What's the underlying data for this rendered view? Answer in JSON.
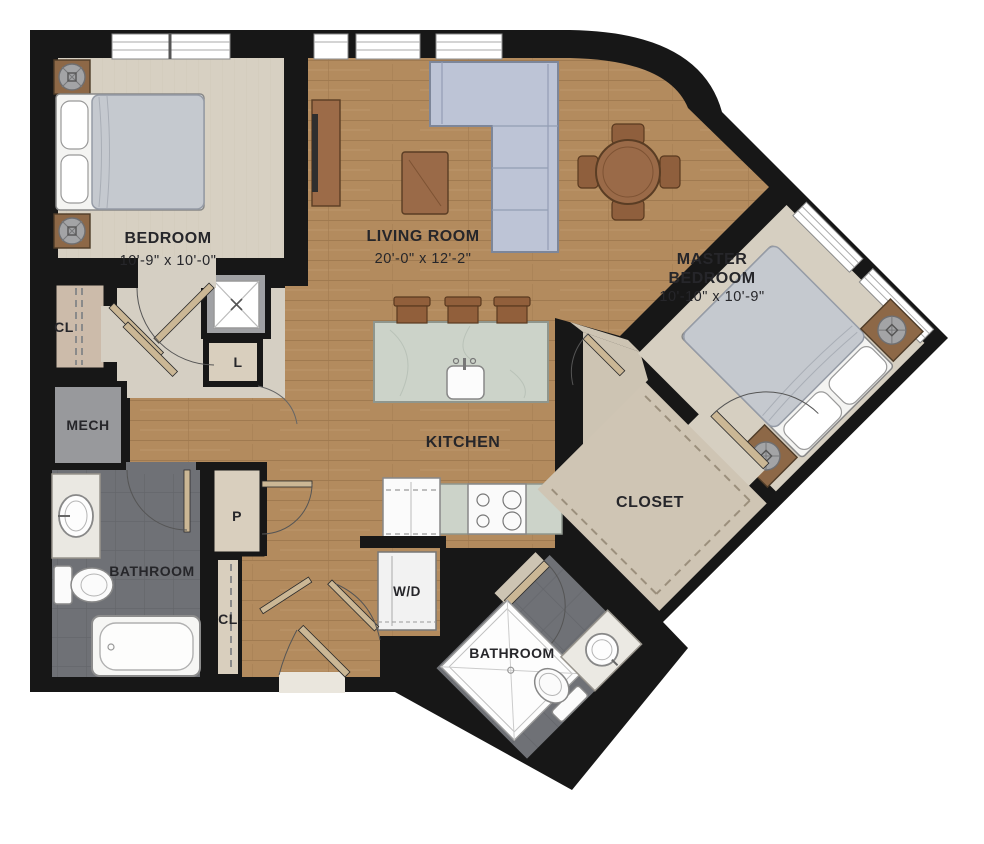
{
  "rooms": {
    "bedroom": {
      "name": "BEDROOM",
      "dims": "10'-9\" x 10'-0\""
    },
    "living_room": {
      "name": "LIVING ROOM",
      "dims": "20'-0\" x 12'-2\""
    },
    "master_bedroom": {
      "name_line1": "MASTER",
      "name_line2": "BEDROOM",
      "dims": "10'-10\" x 10'-9\""
    },
    "kitchen": {
      "name": "KITCHEN"
    },
    "bathroom_left": {
      "name": "BATHROOM"
    },
    "bathroom_right": {
      "name": "BATHROOM"
    },
    "walk_in_closet": {
      "name": "CLOSET"
    }
  },
  "labels": {
    "closet_left": "CL",
    "closet_hall": "CL",
    "linen": "L",
    "pantry": "P",
    "mechanical": "MECH",
    "washer_dryer": "W/D"
  },
  "colors": {
    "wall": "#171717",
    "wood_floor": "#b38b5e",
    "carpet": "#d7d0c2",
    "tile": "#6f7176",
    "marble": "#ccd3c9",
    "sofa": "#bdc4d6",
    "wood_furniture": "#9a6a48"
  }
}
